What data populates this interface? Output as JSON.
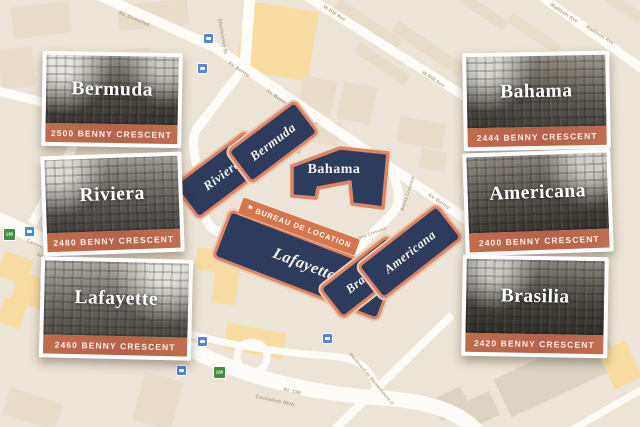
{
  "colors": {
    "map_background": "#ece4d6",
    "building_block": "#e7ddc8",
    "building_block_yellow": "#f8dca2",
    "road": "#fdfcf8",
    "footprint_navy": "#2d3c5c",
    "footprint_border_terracotta": "#de8465",
    "card_banner_orange": "#b4634a",
    "rental_banner_orange": "#d5764f",
    "transit_icon_blue": "#4e86d8",
    "route_shield_green": "#3f8f3f"
  },
  "cards": [
    {
      "name": "Bermuda",
      "address": "2500 BENNY CRESCENT"
    },
    {
      "name": "Riviera",
      "address": "2480 BENNY CRESCENT"
    },
    {
      "name": "Lafayette",
      "address": "2460 BENNY CRESCENT"
    },
    {
      "name": "Bahama",
      "address": "2444 BENNY CRESCENT"
    },
    {
      "name": "Americana",
      "address": "2400 BENNY CRESCENT"
    },
    {
      "name": "Brasilia",
      "address": "2420 BENNY CRESCENT"
    }
  ],
  "footprints": {
    "riviera": "Riviera",
    "bermuda": "Bermuda",
    "bahama": "Bahama",
    "lafayette": "Lafayette",
    "brasilia": "Brasilia",
    "americana": "Americana"
  },
  "rental_office": {
    "label": "BUREAU DE LOCATION",
    "icon": "flag-icon"
  },
  "map": {
    "labels": {
      "somerled": "Av. Somerled",
      "sherbrooke": "Sherbrooke St",
      "benny": "Av. Benny",
      "whill": "W Hill Ave",
      "madison": "Madison Ave",
      "crescent": "Benny Crescent",
      "cavendish": "Cavendish Blvd",
      "rt138": "Rt. 138",
      "maisonneuve": "Boulevard de Maisonneuve O",
      "shield": "138"
    }
  }
}
